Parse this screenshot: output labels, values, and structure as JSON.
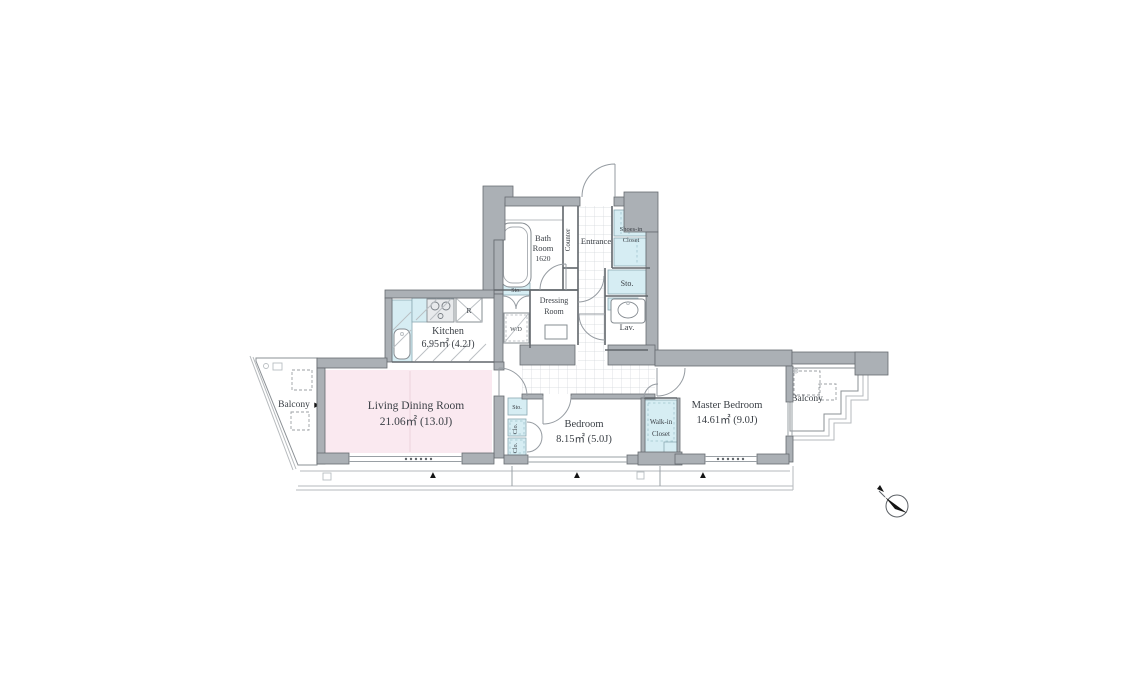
{
  "colors": {
    "wall_gray": "#abb0b5",
    "living_pink": "#fae9f0",
    "fixture_blue": "#d6edf3",
    "outline": "#61666b"
  },
  "rooms": {
    "living_dining": {
      "name": "Living Dining Room",
      "area": "21.06㎡ (13.0J)"
    },
    "kitchen": {
      "name": "Kitchen",
      "area": "6.95㎡ (4.2J)"
    },
    "bedroom": {
      "name": "Bedroom",
      "area": "8.15㎡ (5.0J)"
    },
    "master_bedroom": {
      "name": "Master Bedroom",
      "area": "14.61㎡ (9.0J)"
    },
    "bath_room": {
      "line1": "Bath",
      "line2": "Room",
      "size": "1620"
    },
    "entrance": {
      "name": "Entrance"
    },
    "counter": {
      "name": "Counter"
    },
    "dressing_room": {
      "line1": "Dressing",
      "line2": "Room"
    },
    "lavatory": {
      "name": "Lav."
    },
    "washer_dryer": {
      "name": "W/D"
    },
    "refrigerator": {
      "name": "R"
    },
    "shoes_in_closet": {
      "line1": "Shoes-in",
      "line2": "Closet"
    },
    "walk_in_closet": {
      "line1": "Walk-in",
      "line2": "Closet"
    },
    "storage": {
      "name": "Sto."
    },
    "closet": {
      "name": "Clo."
    },
    "balcony": {
      "name": "Balcony"
    }
  },
  "markers": {
    "window_triangle": "▲",
    "arrow_right": "▶",
    "arrow_left": "◀"
  }
}
